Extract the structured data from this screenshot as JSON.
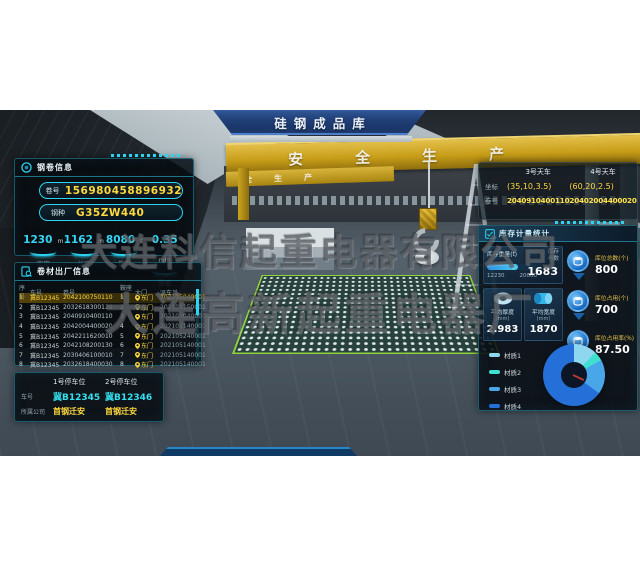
{
  "banner": {
    "title": "硅钢成品库"
  },
  "scene": {
    "girder_text": "安全生产",
    "girder_text_sub": "全生产"
  },
  "watermark": {
    "line1": "大连科信起重电器有限公司",
    "line2": "大连高新起重电器厂"
  },
  "coil_panel": {
    "title": "钢卷信息",
    "fields": [
      {
        "label": "卷号",
        "value": "156980458896932"
      },
      {
        "label": "钢种",
        "value": "G35ZW440"
      }
    ],
    "stats": [
      {
        "value": "1230",
        "unit": "m",
        "label": "宽度"
      },
      {
        "value": "1162",
        "unit": "m",
        "label": "长度"
      },
      {
        "value": "8080",
        "unit": "t",
        "label": "卷重"
      },
      {
        "value": "0.35",
        "unit": "mm",
        "label": "厚度"
      }
    ]
  },
  "shipment_panel": {
    "title": "卷材出厂信息",
    "columns": [
      "序号",
      "车号",
      "卷号",
      "鞍座号",
      "大门",
      "派车单"
    ],
    "rows": [
      {
        "seq": "1",
        "truck": "冀B12345",
        "coil": "2042100750110",
        "saddle": "1",
        "gate": "东门",
        "order": "202105040001"
      },
      {
        "seq": "2",
        "truck": "冀B12345",
        "coil": "2032618300120",
        "saddle": "2",
        "gate": "东门",
        "order": "202105150001"
      },
      {
        "seq": "3",
        "truck": "冀B12345",
        "coil": "2040910400110",
        "saddle": "3",
        "gate": "东门",
        "order": "202105040001"
      },
      {
        "seq": "4",
        "truck": "冀B12345",
        "coil": "2042004400020",
        "saddle": "4",
        "gate": "东门",
        "order": "202105140001"
      },
      {
        "seq": "5",
        "truck": "冀B12345",
        "coil": "2042211620010",
        "saddle": "5",
        "gate": "东门",
        "order": "202105240001"
      },
      {
        "seq": "6",
        "truck": "冀B12345",
        "coil": "2042108200130",
        "saddle": "6",
        "gate": "东门",
        "order": "202105140001"
      },
      {
        "seq": "7",
        "truck": "冀B12345",
        "coil": "2030406100010",
        "saddle": "7",
        "gate": "东门",
        "order": "202105140001"
      },
      {
        "seq": "8",
        "truck": "冀B12345",
        "coil": "2032618400030",
        "saddle": "8",
        "gate": "东门",
        "order": "202105140001"
      }
    ]
  },
  "parking_panel": {
    "plate_label": "车号",
    "company_label": "所属公司",
    "spots": [
      {
        "title": "1号停车位",
        "plate": "冀B12345",
        "company": "首钢迁安"
      },
      {
        "title": "2号停车位",
        "plate": "冀B12346",
        "company": "首钢迁安"
      }
    ]
  },
  "crane_panel": {
    "coord_label": "坐标",
    "coil_label": "卷号",
    "cranes": [
      "3号天车",
      "4号天车"
    ],
    "coords": [
      "(35,10,3.5)",
      "(60,20,2.5)"
    ],
    "coils": [
      "2040910400110",
      "20402004400020"
    ]
  },
  "inventory_panel": {
    "title": "库存计量统计",
    "weight_card": {
      "title": "库存重量(t)",
      "current": 12230,
      "capacity": 20000,
      "current_label": "12230",
      "capacity_label": "20000",
      "count_label_1": "库存",
      "count_label_2": "卷数",
      "count": "1683"
    },
    "avg_cards": [
      {
        "label": "平均厚度",
        "unit": "(mm)",
        "value": "2.983"
      },
      {
        "label": "平均宽度",
        "unit": "(mm)",
        "value": "1870"
      }
    ],
    "stats": [
      {
        "label": "库位总数(个)",
        "value": "800"
      },
      {
        "label": "库位占用(个)",
        "value": "700"
      },
      {
        "label": "库位占用率(%)",
        "value": "87.50"
      }
    ],
    "chart_data": {
      "type": "pie",
      "donut": true,
      "title": "材质占比",
      "categories": [
        "材质1",
        "材质2",
        "材质3",
        "材质4"
      ],
      "values": [
        12,
        5,
        18,
        65
      ],
      "colors": [
        "#8fd6ef",
        "#3fe0d0",
        "#49a6e8",
        "#2470d8"
      ],
      "legend_position": "left"
    }
  }
}
